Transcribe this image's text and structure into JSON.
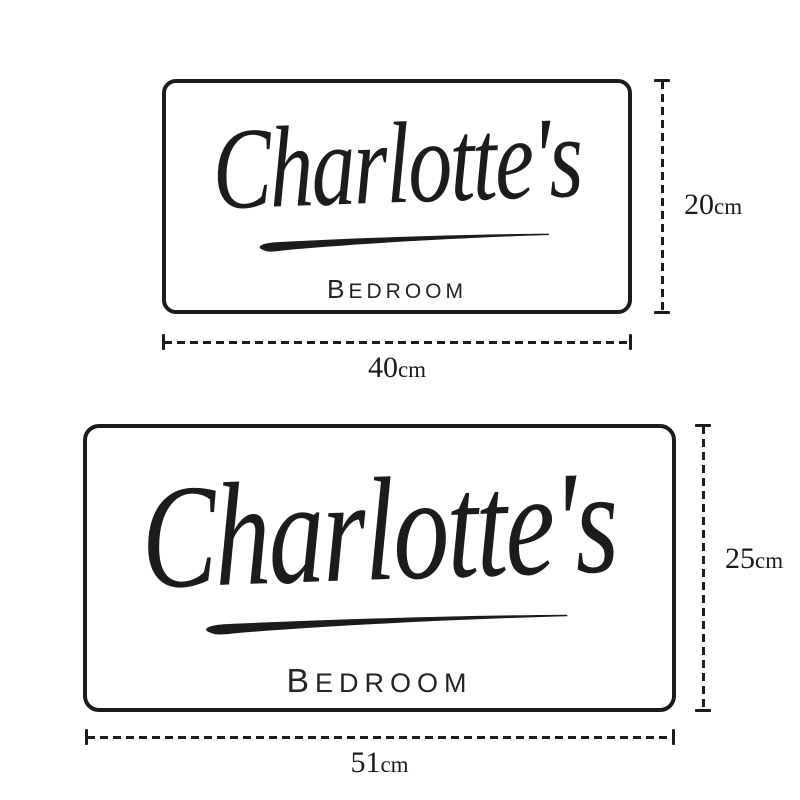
{
  "diagram": {
    "description": "Two personalised room sign size options",
    "signs": [
      {
        "size_id": "small",
        "name": "Charlotte's",
        "room": "BEDROOM",
        "height": {
          "value": "20",
          "unit": "cm"
        },
        "width": {
          "value": "40",
          "unit": "cm"
        }
      },
      {
        "size_id": "large",
        "name": "Charlotte's",
        "room": "BEDROOM",
        "height": {
          "value": "25",
          "unit": "cm"
        },
        "width": {
          "value": "51",
          "unit": "cm"
        }
      }
    ]
  },
  "colors": {
    "ink": "#1c1c1c",
    "background": "#ffffff",
    "sign_fill": "#ffffff"
  }
}
